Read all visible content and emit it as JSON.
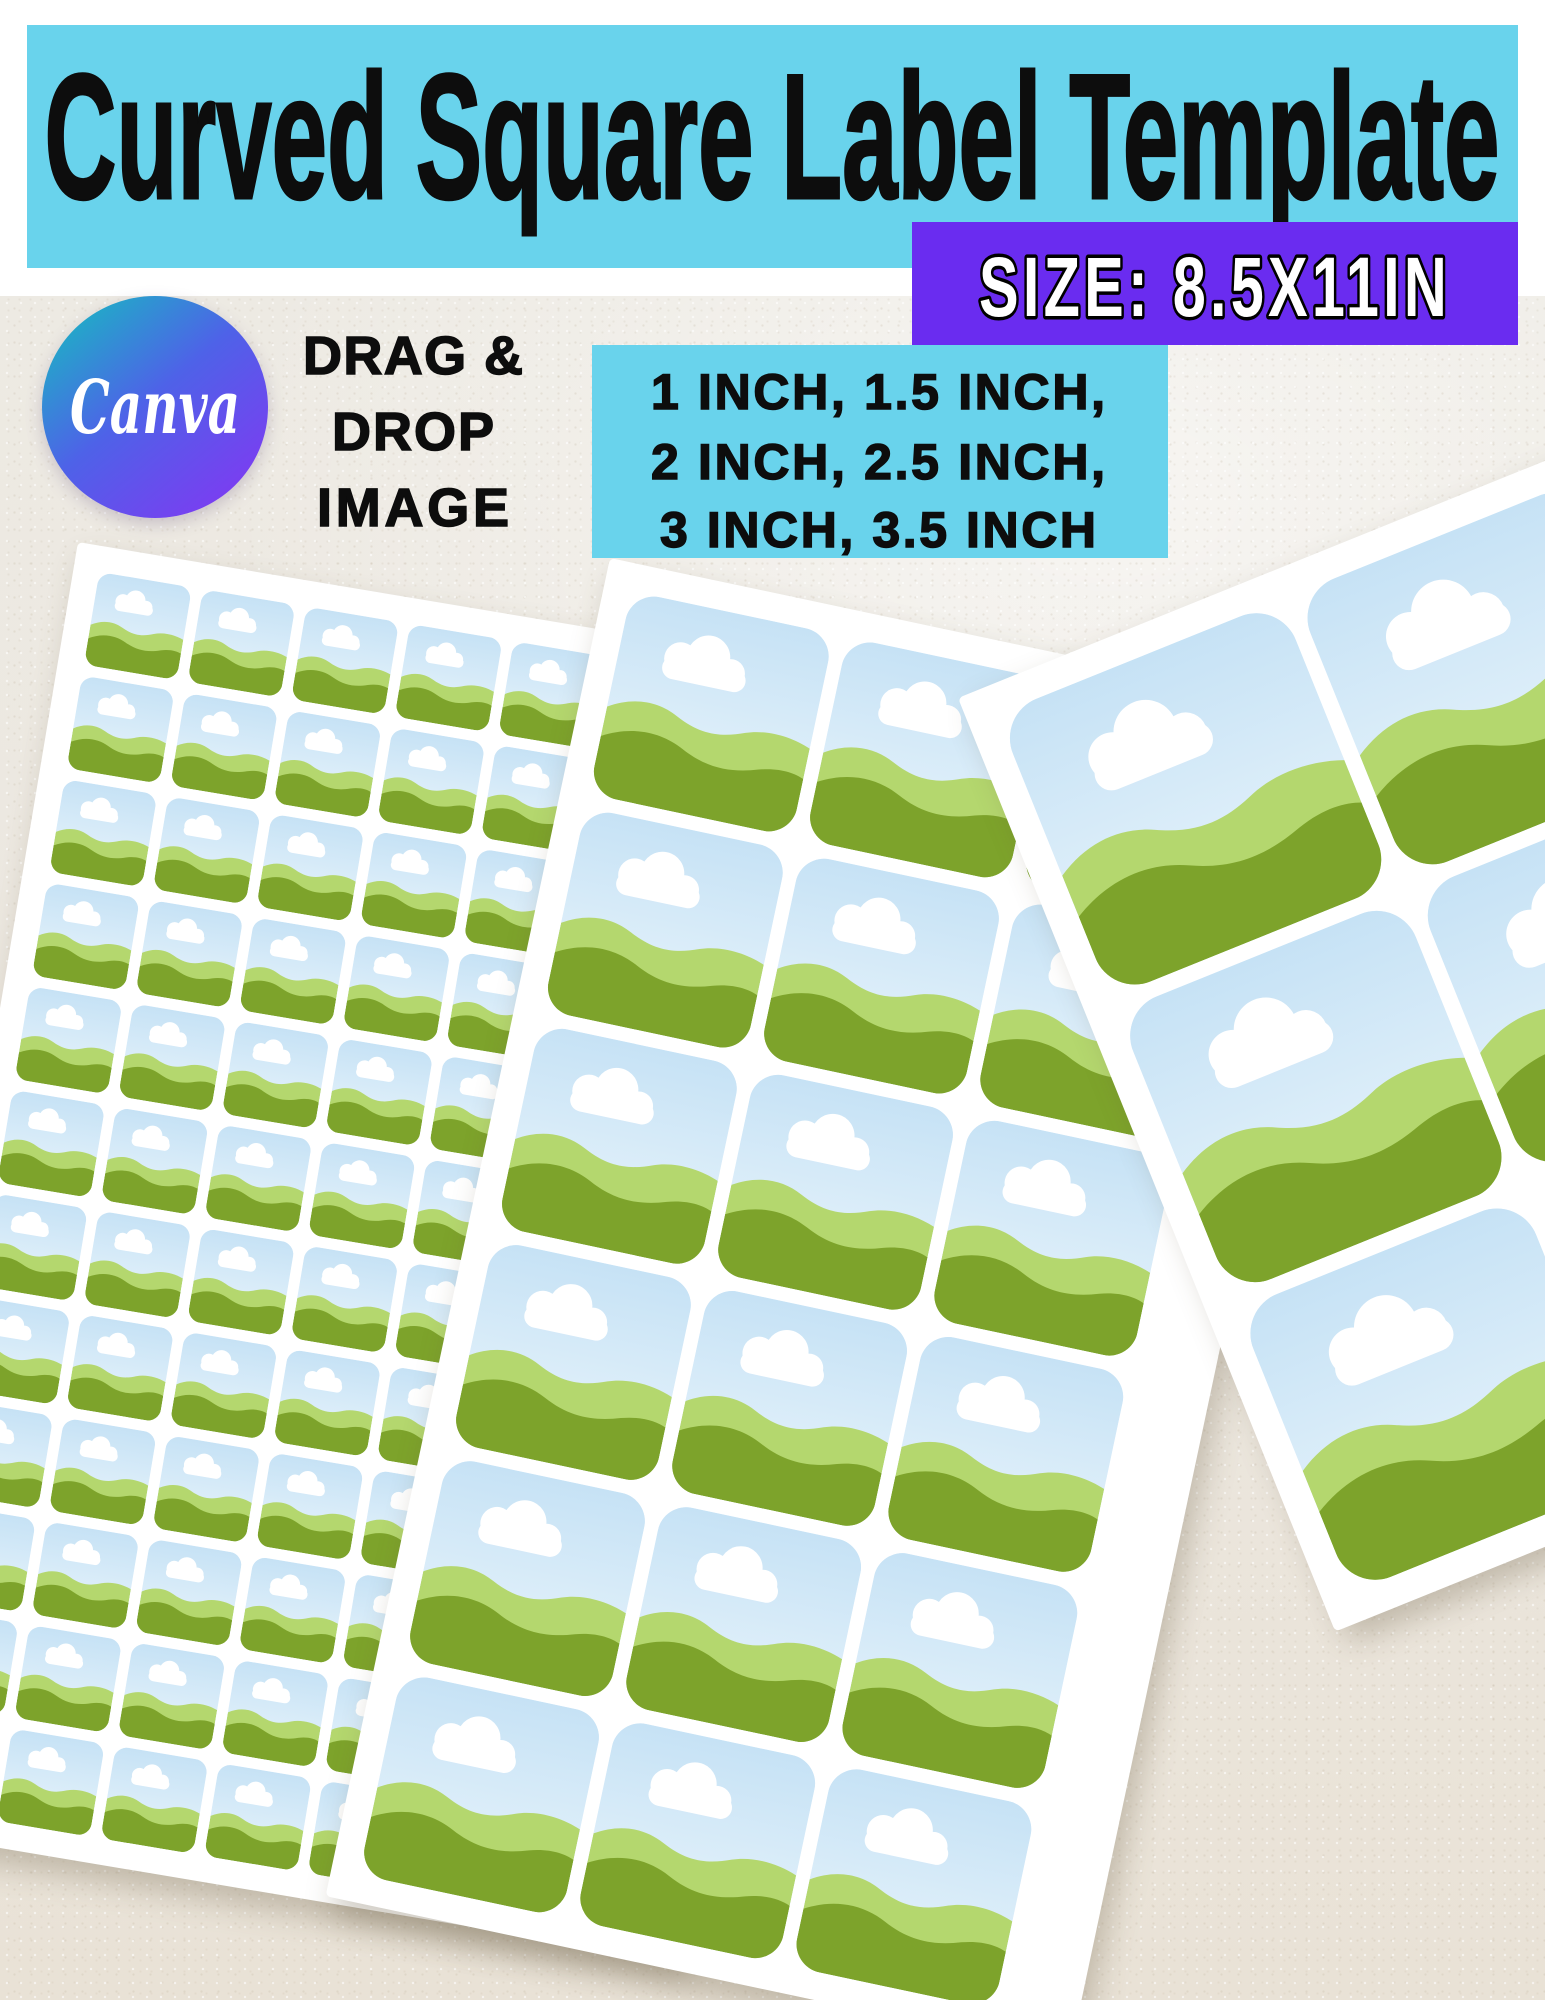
{
  "header": {
    "title": "Curved Square Label Template",
    "bg": "#69d3ec",
    "text_color": "#0d0d0d"
  },
  "size_banner": {
    "label": "SIZE: 8.5X11IN",
    "bg": "#6a2cf0",
    "text_fill": "#ffffff",
    "text_stroke": "#000000"
  },
  "canva_badge": {
    "text": "Canva",
    "text_color": "#ffffff",
    "gradient_start": "#12c3bd",
    "gradient_mid": "#4e62e8",
    "gradient_end": "#8039f2"
  },
  "drag_drop": {
    "line1": "DRAG &",
    "line2": "DROP",
    "line3": "IMAGE",
    "text_color": "#0d0d0d"
  },
  "sizes_box": {
    "bg": "#69d3ec",
    "text_color": "#0d0d0d",
    "line1": "1 INCH, 1.5 INCH,",
    "line2": "2 INCH, 2.5 INCH,",
    "line3": "3 INCH, 3.5 INCH"
  },
  "paper": {
    "base": "#ece7df"
  },
  "artwork": {
    "sheet_bg": "#ffffff",
    "sky_top": "#c6e2f5",
    "sky_bottom": "#eaf5fc",
    "cloud": "#ffffff",
    "hill_light": "#b4d76e",
    "hill_dark": "#7da32b"
  }
}
